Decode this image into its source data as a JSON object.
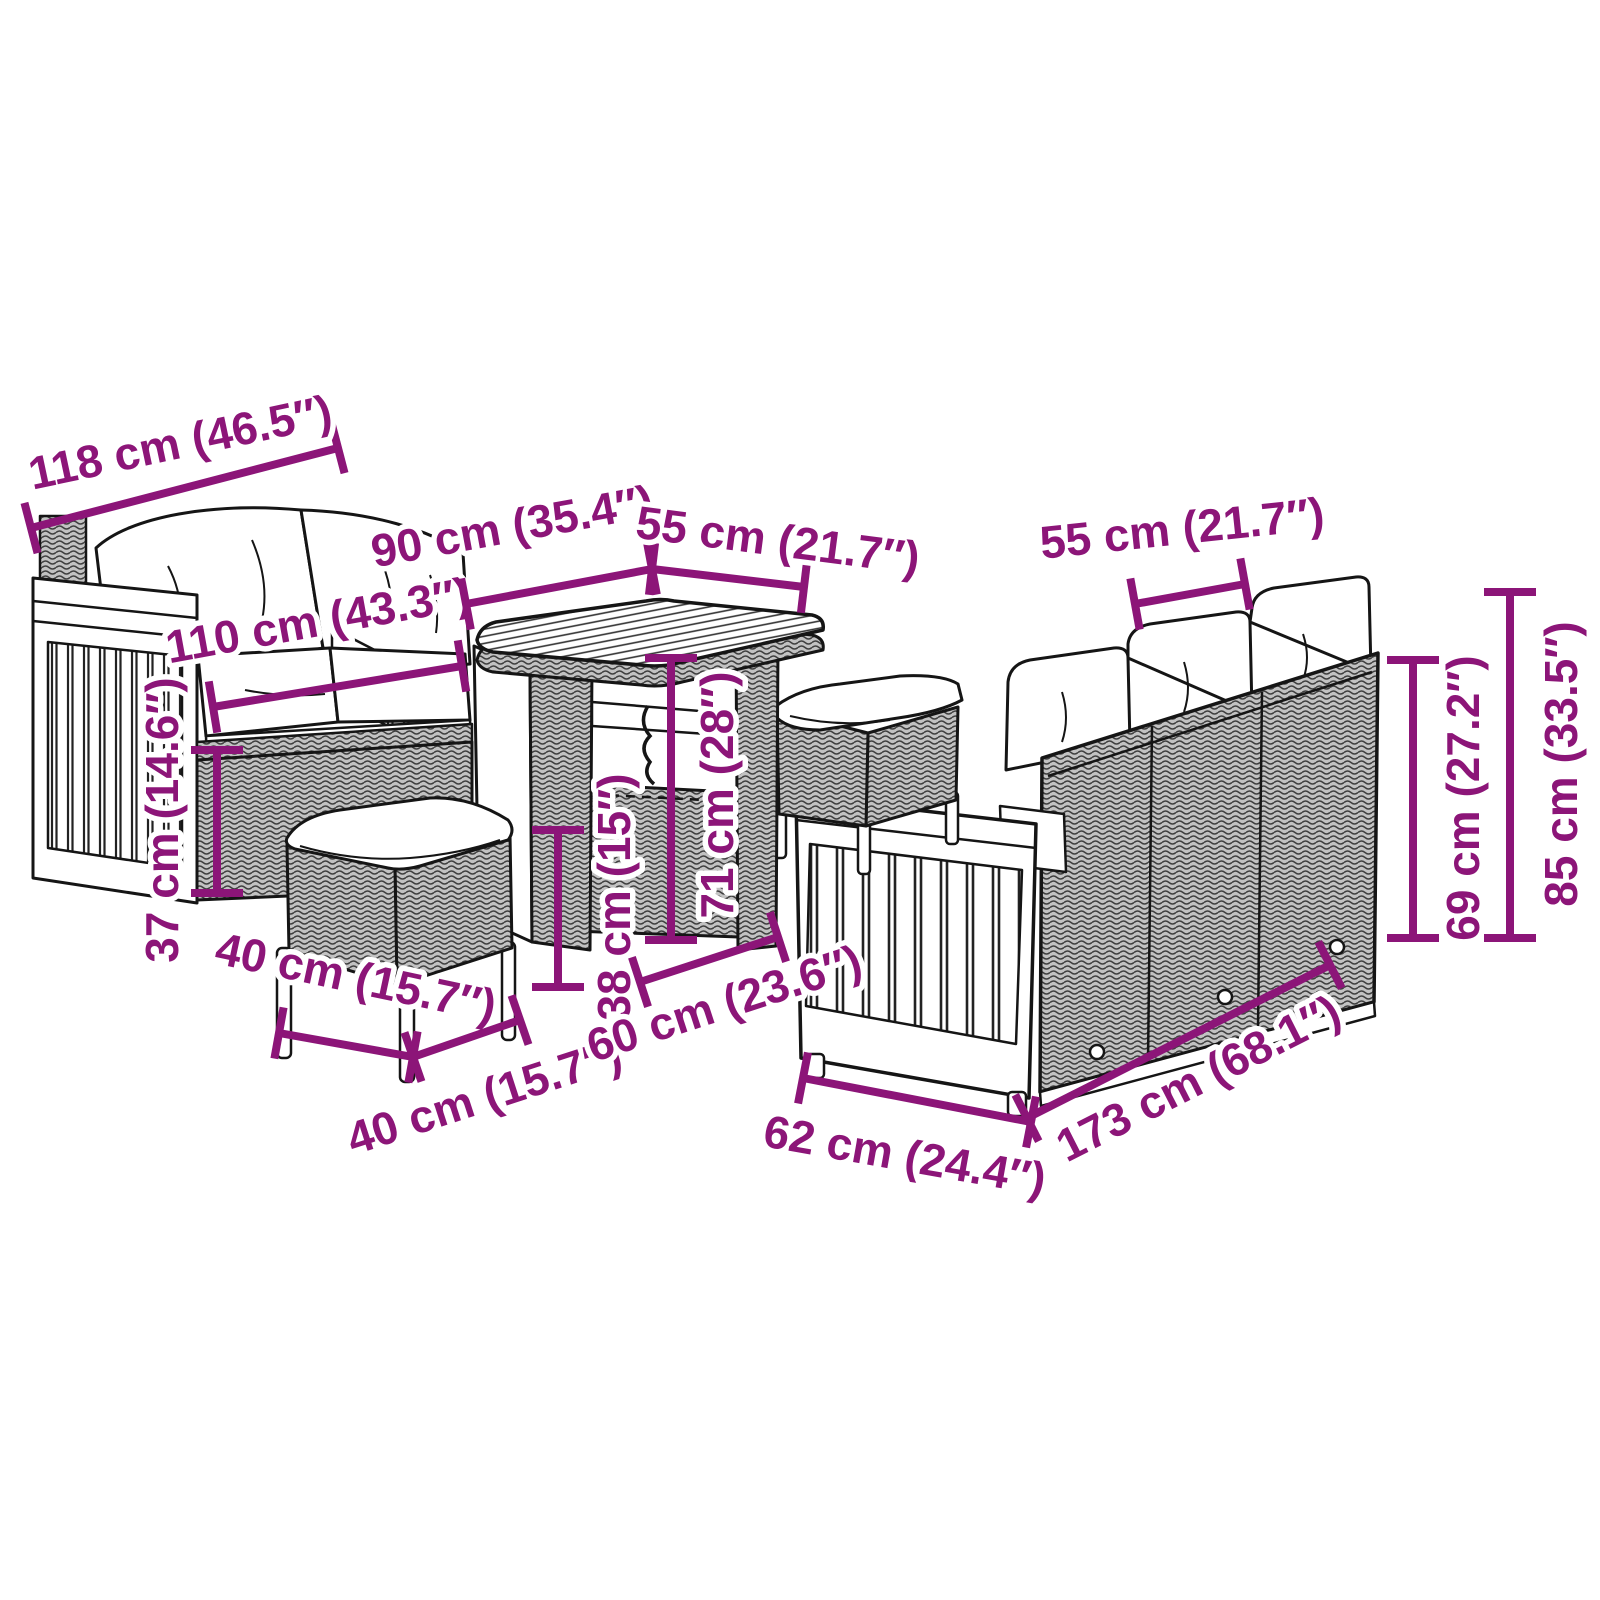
{
  "style": {
    "dimension_color": "#8C1578",
    "art_line_color": "#151515",
    "background": "#FFFFFF",
    "rattan_grey": "#C2C2C2",
    "weave_dark": "#3F3F3F",
    "font_size": 46,
    "tick_half": 26,
    "stroke_width": 8
  },
  "dimensions": [
    {
      "id": "sofa2-overall-width",
      "label": "118 cm (46.5″)",
      "x1": 31,
      "y1": 528,
      "x2": 338,
      "y2": 448,
      "tx": 180,
      "ty": 442,
      "rot": -12
    },
    {
      "id": "sofa2-seat-width",
      "label": "110 cm (43.3″)",
      "x1": 213,
      "y1": 707,
      "x2": 462,
      "y2": 666,
      "tx": 318,
      "ty": 620,
      "rot": -10.3
    },
    {
      "id": "table-length",
      "label": "90 cm (35.4″)",
      "x1": 466,
      "y1": 604,
      "x2": 652,
      "y2": 569,
      "tx": 512,
      "ty": 526,
      "rot": -10.4
    },
    {
      "id": "table-width",
      "label": "55 cm (21.7″)",
      "x1": 652,
      "y1": 569,
      "x2": 804,
      "y2": 587,
      "tx": 778,
      "ty": 540,
      "rot": 7.4
    },
    {
      "id": "table-height",
      "label": "71 cm (28″)",
      "x1": 671,
      "y1": 658,
      "x2": 671,
      "y2": 940,
      "tx": 717,
      "ty": 795,
      "rot": -90
    },
    {
      "id": "stool-height",
      "label": "38 cm (15″)",
      "x1": 558,
      "y1": 830,
      "x2": 558,
      "y2": 987,
      "tx": 614,
      "ty": 897,
      "rot": -90
    },
    {
      "id": "sofa2-seat-height",
      "label": "37 cm (14.6″)",
      "x1": 217,
      "y1": 750,
      "x2": 217,
      "y2": 893,
      "tx": 162,
      "ty": 820,
      "rot": -90
    },
    {
      "id": "sofa3-seat-width",
      "label": "55 cm (21.7″)",
      "x1": 1135,
      "y1": 604,
      "x2": 1245,
      "y2": 584,
      "tx": 1182,
      "ty": 528,
      "rot": -6
    },
    {
      "id": "sofa3-back-height",
      "label": "69 cm (27.2″)",
      "x1": 1413,
      "y1": 660,
      "x2": 1413,
      "y2": 938,
      "tx": 1463,
      "ty": 798,
      "rot": -90
    },
    {
      "id": "sofa3-total-height",
      "label": "85 cm (33.5″)",
      "x1": 1510,
      "y1": 592,
      "x2": 1510,
      "y2": 938,
      "tx": 1561,
      "ty": 764,
      "rot": -90
    },
    {
      "id": "stool-depth",
      "label": "40 cm (15.7″)",
      "x1": 279,
      "y1": 1033,
      "x2": 413,
      "y2": 1057,
      "tx": 356,
      "ty": 977,
      "rot": 12
    },
    {
      "id": "stool-width",
      "label": "40 cm (15.7″)",
      "x1": 413,
      "y1": 1057,
      "x2": 520,
      "y2": 1020,
      "tx": 484,
      "ty": 1096,
      "rot": -18
    },
    {
      "id": "sofa3-seat-depth",
      "label": "60 cm (23.6″)",
      "x1": 640,
      "y1": 982,
      "x2": 778,
      "y2": 937,
      "tx": 724,
      "ty": 1003,
      "rot": -18
    },
    {
      "id": "sofa3-depth",
      "label": "62 cm (24.4″)",
      "x1": 803,
      "y1": 1078,
      "x2": 1031,
      "y2": 1122,
      "tx": 905,
      "ty": 1155,
      "rot": 10
    },
    {
      "id": "sofa3-length",
      "label": "173 cm (68.1″)",
      "x1": 1027,
      "y1": 1118,
      "x2": 1330,
      "y2": 965,
      "tx": 1198,
      "ty": 1078,
      "rot": -27
    }
  ]
}
